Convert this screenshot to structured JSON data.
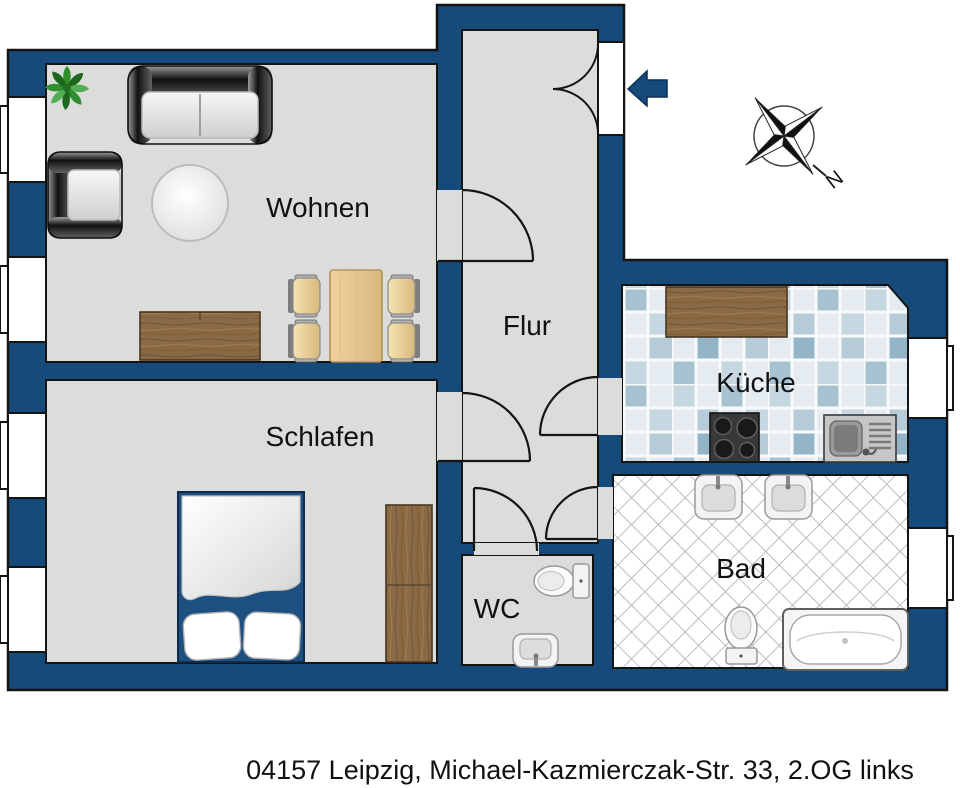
{
  "caption": {
    "text": "04157 Leipzig, Michael-Kazmierczak-Str. 33, 2.OG links"
  },
  "rooms": {
    "wohnen": {
      "label": "Wohnen"
    },
    "flur": {
      "label": "Flur"
    },
    "kueche": {
      "label": "Küche"
    },
    "schlafen": {
      "label": "Schlafen"
    },
    "wc": {
      "label": "WC"
    },
    "bad": {
      "label": "Bad"
    }
  },
  "compass": {
    "north_label": "N"
  },
  "colors": {
    "wall": "#164a7b",
    "floor": "#dcdcda",
    "kitchen_tile_accent": "#a9c2d2",
    "bath_tile_line": "#a8a8a8",
    "wood": "#8a6a45",
    "entrance_arrow": "#164a7b"
  }
}
